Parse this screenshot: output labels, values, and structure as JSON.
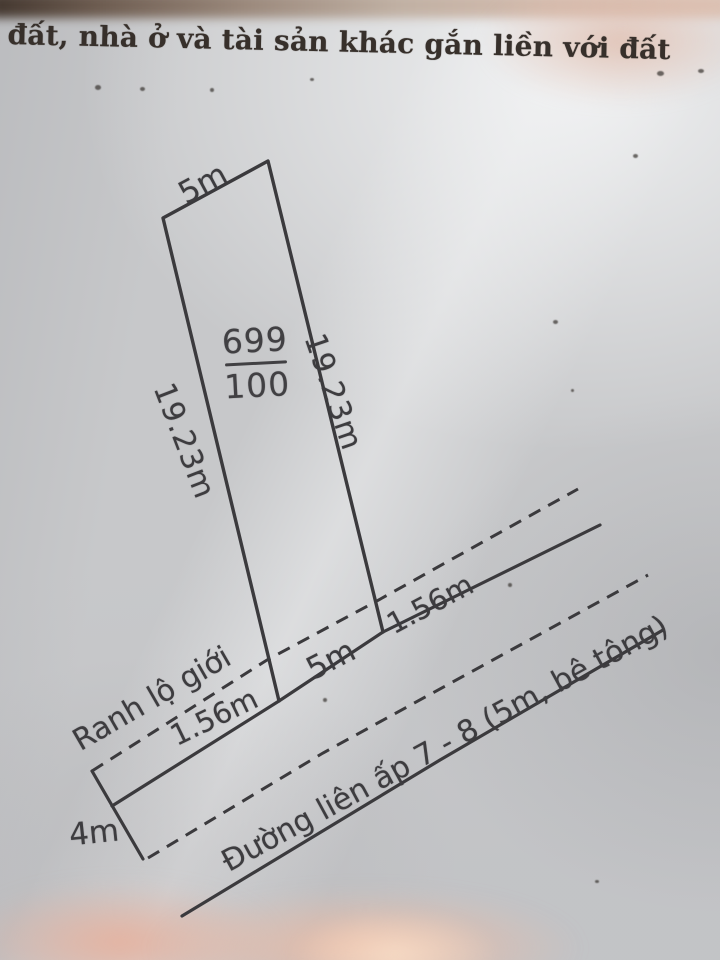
{
  "header": {
    "title": "đất, nhà ở và tài sản khác gắn liền với đất"
  },
  "parcel": {
    "lot_number": "699",
    "area": "100",
    "top_width_label": "5m",
    "left_length_label": "19.23m",
    "right_length_label": "19.23m"
  },
  "road": {
    "boundary_label": "Ranh lộ giới",
    "left_offset_label": "1.56m",
    "frontage_label": "5m",
    "right_offset_label": "1.56m",
    "end_width_label": "4m",
    "name_label": "Đường liên ấp 7 - 8 (5m, bê tông)"
  },
  "colors": {
    "line": "#3b3a3d",
    "label_text": "#3d3c3f",
    "header_text": "#37302b",
    "paper": "#c7c8ca"
  }
}
